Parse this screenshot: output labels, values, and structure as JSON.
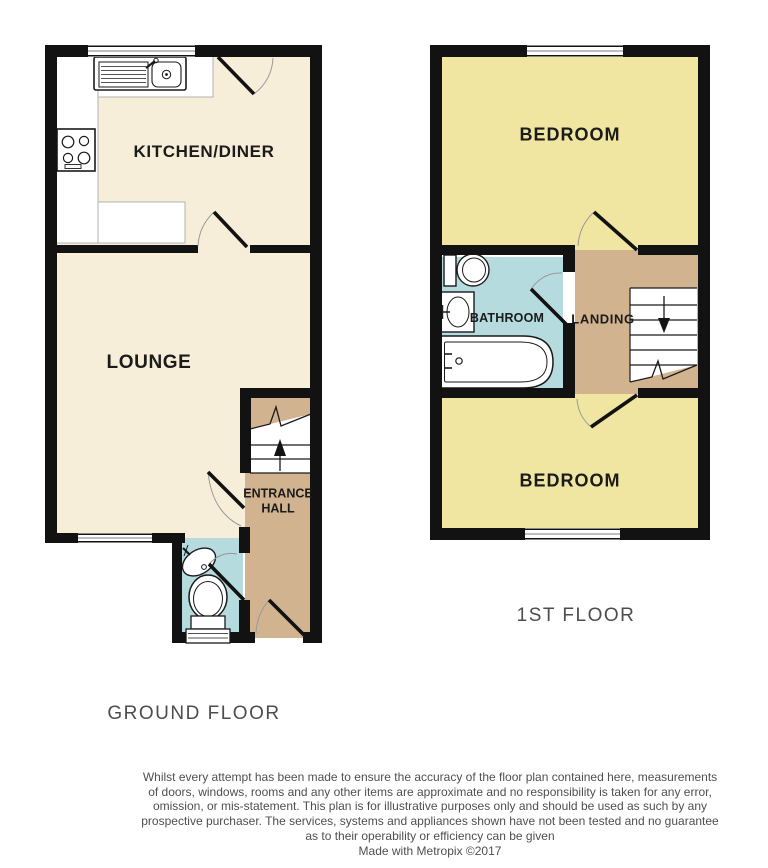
{
  "floorplan": {
    "ground_floor": {
      "title": "GROUND FLOOR",
      "rooms": {
        "kitchen": "KITCHEN/DINER",
        "lounge": "LOUNGE",
        "entrance_hall": "ENTRANCE HALL"
      }
    },
    "first_floor": {
      "title": "1ST FLOOR",
      "rooms": {
        "bedroom_front": "BEDROOM",
        "bathroom": "BATHROOM",
        "landing": "LANDING",
        "bedroom_back": "BEDROOM"
      }
    },
    "colors": {
      "floor_cream": "#f7eed9",
      "floor_yellow": "#f0e6a2",
      "floor_tan": "#d2b38f",
      "floor_blue": "#b6dbdf",
      "wall": "#121212"
    },
    "footer": {
      "disclaimer_lines": [
        "Whilst every attempt has been made to ensure the accuracy of the floor plan contained here, measurements",
        "of doors, windows, rooms and any other items are approximate and no responsibility is taken for any error,",
        "omission, or mis-statement. This plan is for illustrative purposes only and should be used as such by any",
        "prospective purchaser. The services, systems and appliances shown have not been tested and no guarantee",
        "as to their operability or efficiency can be given"
      ],
      "credit": "Made with Metropix ©2017"
    }
  }
}
